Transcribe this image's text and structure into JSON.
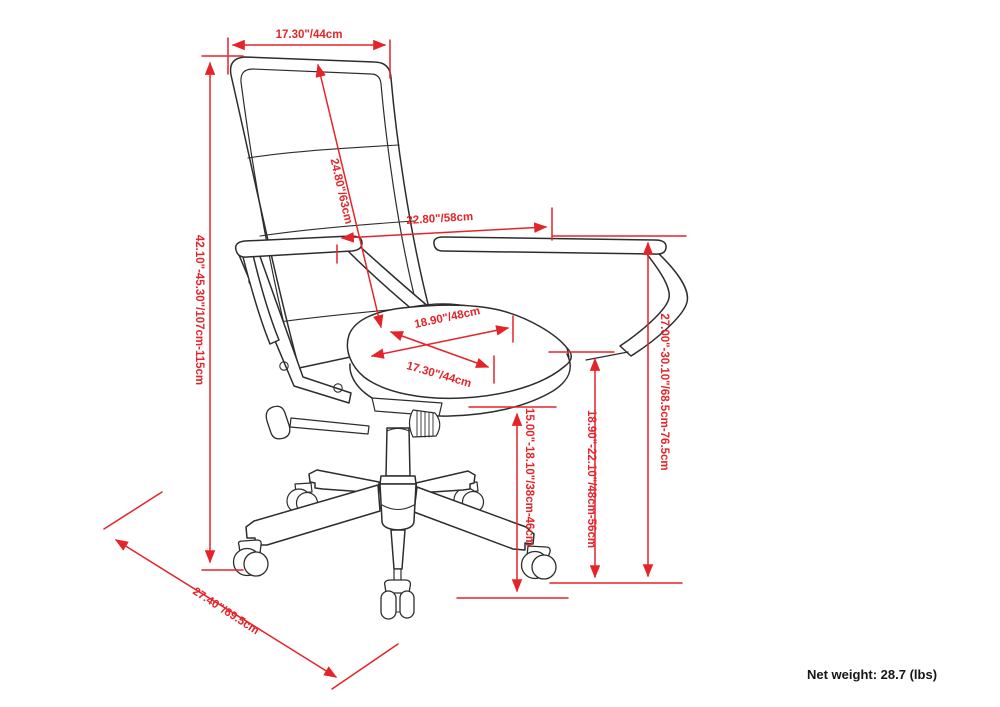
{
  "diagram": {
    "type": "product-dimension-drawing",
    "subject": "high-back office swivel chair",
    "colors": {
      "dimension_red": "#e5242a",
      "line_art": "#2d2d2d",
      "background": "#ffffff"
    },
    "dimensions": [
      {
        "name": "backrest-width",
        "label": "17.30\"/44cm"
      },
      {
        "name": "backrest-diagonal-height",
        "label": "24.80\"/63cm"
      },
      {
        "name": "overall-depth-arm-span",
        "label": "22.80\"/58cm"
      },
      {
        "name": "seat-width",
        "label": "18.90\"/48cm"
      },
      {
        "name": "seat-depth",
        "label": "17.30\"/44cm"
      },
      {
        "name": "overall-height-range",
        "label": "42.10\"-45.30\"/107cm-115cm"
      },
      {
        "name": "armrest-height-range",
        "label": "27.00\"-30.10\"/68.5cm-76.5cm"
      },
      {
        "name": "seat-height-range",
        "label": "18.90\"-22.10\"/48cm-56cm"
      },
      {
        "name": "seat-front-height-range",
        "label": "15.00\"-18.10\"/38cm-46cm"
      },
      {
        "name": "base-diameter",
        "label": "27.40\"/69.5cm"
      }
    ],
    "net_weight": "Net weight: 28.7 (lbs)"
  }
}
